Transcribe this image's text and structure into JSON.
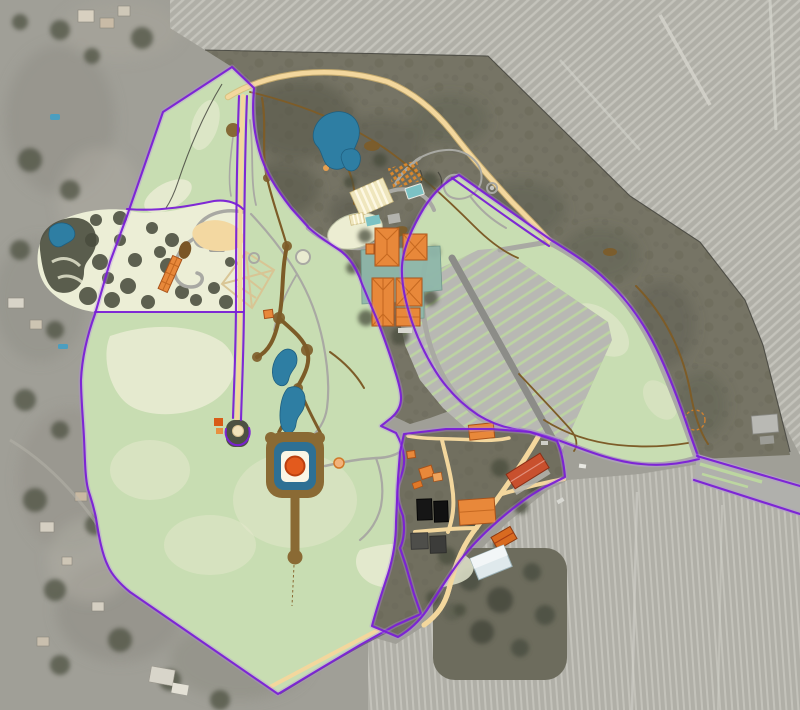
{
  "map": {
    "name": "estate-aerial-site-plan-map",
    "regions": [
      "vineyard-northeast",
      "vineyard-southeast",
      "scrubland",
      "suburb-west",
      "garden-grove",
      "great-lawn",
      "north-corridor",
      "parking-grove",
      "winery-complex",
      "farm-complex",
      "keyhole-fountain",
      "ponds",
      "bottom-right-road-arm"
    ],
    "features": [
      "property-boundary-purple",
      "driveway-allee",
      "main-tan-road",
      "gray-loop-roads",
      "dirt-trails",
      "parking-rows",
      "solar-panels",
      "barns",
      "kite-trellis",
      "sand-patch",
      "oval-lawn",
      "cul-de-sac"
    ]
  },
  "colors": {
    "lawn": "#c8ddb2",
    "lawnPale": "#eaecd3",
    "lawnStripe": "#bcd6a0",
    "water": "#2e7ea3",
    "waterEdge": "#1f5f80",
    "pool": "#7cc2c4",
    "boundary": "#7a1fd6",
    "boundaryGlow": "#b58ae8",
    "roadTan": "#f3d79d",
    "roadTanEdge": "#d9b870",
    "roadGray": "#a9a9a3",
    "roadGrayDark": "#8c8c88",
    "trail": "#7d5c28",
    "building": "#e8883a",
    "buildingEdge": "#a8521a",
    "buildingRidge": "#c2661f",
    "orchard": "#d9882e",
    "barnRed": "#c8502e",
    "terrace": "#8fb7aa",
    "cream": "#efe6bd",
    "sand": "#f3d8a1",
    "aerialBase": "#a09f97",
    "vineBase": "#b0afa7",
    "vineStripe": "#c8c7bf",
    "scrub": "#767465",
    "scrubDark": "#565849",
    "forest": "#4a4d3e",
    "solarBlack": "#161616",
    "panelGray": "#4e4e4a",
    "paleBldg": "#dfe9ec",
    "fountainOrange": "#e35a1d"
  }
}
